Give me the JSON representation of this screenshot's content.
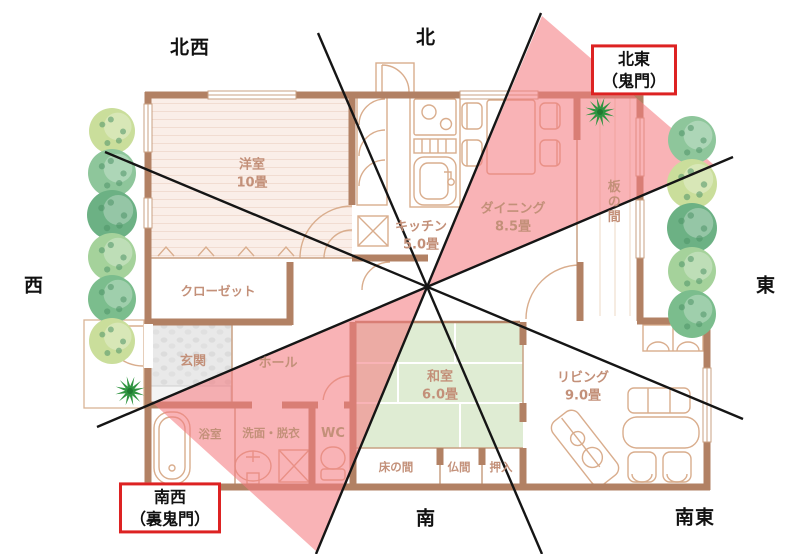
{
  "compass": {
    "north": "北",
    "northwest": "北西",
    "west": "西",
    "east": "東",
    "south": "南",
    "southeast": "南東",
    "northeast_box": {
      "line1": "北東",
      "line2": "（鬼門）"
    },
    "southwest_box": {
      "line1": "南西",
      "line2": "（裏鬼門）"
    }
  },
  "rooms": {
    "yoshitsu": {
      "name": "洋室",
      "size": "10畳"
    },
    "closet": {
      "name": "クローゼット"
    },
    "genkan": {
      "name": "玄関"
    },
    "hall": {
      "name": "ホール"
    },
    "bath": {
      "name": "浴室"
    },
    "senmen": {
      "name": "洗面・脱衣"
    },
    "wc": {
      "name": "WC"
    },
    "kitchen": {
      "name": "キッチン",
      "size": "5.0畳"
    },
    "dining": {
      "name": "ダイニング",
      "size": "8.5畳"
    },
    "itanoma": {
      "name": "板の間"
    },
    "washitsu": {
      "name": "和室",
      "size": "6.0畳"
    },
    "tokonoma": {
      "name": "床の間"
    },
    "butsuma": {
      "name": "仏間"
    },
    "oshiire": {
      "name": "押入"
    },
    "living": {
      "name": "リビング",
      "size": "9.0畳"
    }
  },
  "palette": {
    "wall": "#b28164",
    "outline": "#c9a183",
    "furniture": "#d9ad8d",
    "western_floor": "#faeee8",
    "tatami": "#dfecd3",
    "entry_stone": "#e9e9e9",
    "sector_pink": "#f47c82",
    "sector_opacity": 0.58,
    "line_black": "#151515",
    "warning_red": "#dd2222",
    "room_text": "#c39079",
    "plant_green": "#2f9440",
    "tree_greens": [
      "#cade9b",
      "#8ec69b",
      "#6cb184",
      "#a5d29b",
      "#7bbd8d"
    ]
  },
  "overlay": {
    "center": [
      427,
      287
    ],
    "lines": [
      [
        318,
        33,
        542,
        554
      ],
      [
        541,
        13,
        316,
        554
      ],
      [
        105,
        152,
        743,
        419
      ],
      [
        97,
        427,
        733,
        157
      ]
    ],
    "sectors": [
      {
        "name": "northeast-kimon-sector",
        "points": "427,287 542,16 714,165"
      },
      {
        "name": "southwest-urakimon-sector",
        "points": "427,287 153,403 317,552"
      }
    ],
    "trees_west": {
      "x": 112,
      "items": [
        {
          "y": 131,
          "r": 23,
          "c": 0
        },
        {
          "y": 173,
          "r": 24,
          "c": 1
        },
        {
          "y": 215,
          "r": 25,
          "c": 2
        },
        {
          "y": 257,
          "r": 24,
          "c": 3
        },
        {
          "y": 299,
          "r": 24,
          "c": 4
        },
        {
          "y": 341,
          "r": 23,
          "c": 0
        }
      ]
    },
    "trees_east": {
      "x": 692,
      "items": [
        {
          "y": 140,
          "r": 24,
          "c": 1
        },
        {
          "y": 184,
          "r": 25,
          "c": 0
        },
        {
          "y": 228,
          "r": 25,
          "c": 2
        },
        {
          "y": 271,
          "r": 24,
          "c": 3
        },
        {
          "y": 314,
          "r": 24,
          "c": 4
        }
      ]
    },
    "plants": [
      [
        600,
        112
      ],
      [
        130,
        391
      ]
    ]
  }
}
